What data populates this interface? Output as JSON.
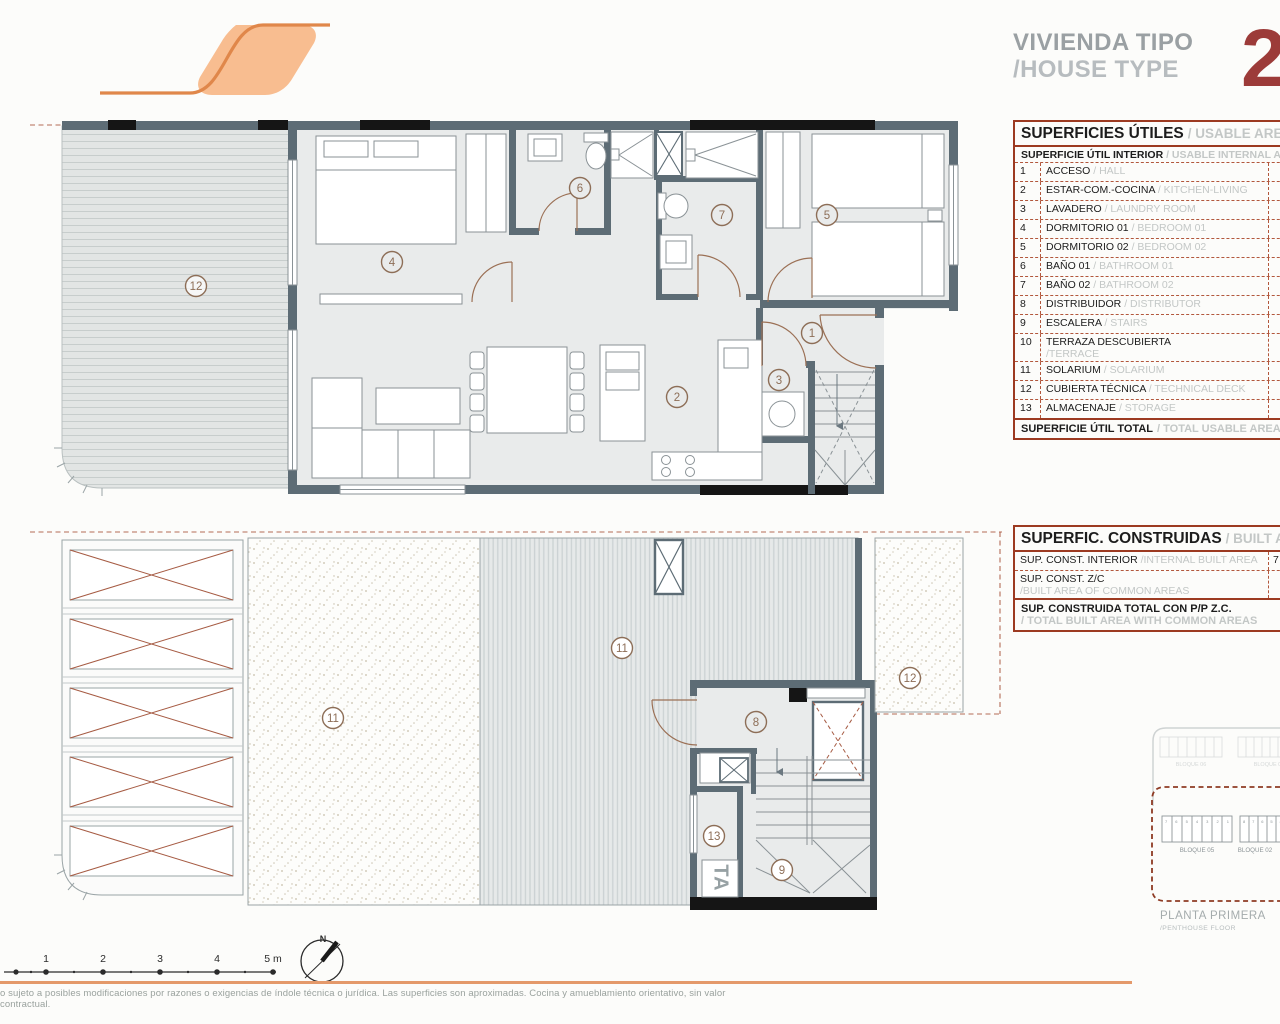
{
  "header": {
    "title_es": "VIVIENDA TIPO",
    "title_en": "/HOUSE TYPE",
    "type_number": "2"
  },
  "usable_table": {
    "title_es": "SUPERFICIES ÚTILES",
    "title_en": "/ USABLE AREA",
    "sub_es": "SUPERFICIE ÚTIL INTERIOR",
    "sub_en": "/ USABLE INTERNAL AREA",
    "rows": [
      {
        "n": "1",
        "es": "ACCESO",
        "en": "/ HALL"
      },
      {
        "n": "2",
        "es": "ESTAR-COM.-COCINA",
        "en": "/ KITCHEN-LIVING"
      },
      {
        "n": "3",
        "es": "LAVADERO",
        "en": "/ LAUNDRY ROOM"
      },
      {
        "n": "4",
        "es": "DORMITORIO 01",
        "en": "/ BEDROOM 01"
      },
      {
        "n": "5",
        "es": "DORMITORIO 02",
        "en": "/ BEDROOM 02"
      },
      {
        "n": "6",
        "es": "BAÑO 01",
        "en": "/ BATHROOM 01"
      },
      {
        "n": "7",
        "es": "BAÑO 02",
        "en": "/ BATHROOM 02"
      },
      {
        "n": "8",
        "es": "DISTRIBUIDOR",
        "en": "/ DISTRIBUTOR"
      },
      {
        "n": "9",
        "es": "ESCALERA",
        "en": "/ STAIRS"
      },
      {
        "n": "10",
        "es": "TERRAZA DESCUBIERTA",
        "en": "/TERRACE"
      },
      {
        "n": "11",
        "es": "SOLARIUM",
        "en": "/ SOLARIUM"
      },
      {
        "n": "12",
        "es": "CUBIERTA TÉCNICA",
        "en": "/ TECHNICAL DECK"
      },
      {
        "n": "13",
        "es": "ALMACENAJE",
        "en": "/ STORAGE"
      }
    ],
    "total_es": "SUPERFICIE ÚTIL TOTAL",
    "total_en": "/ TOTAL USABLE AREA",
    "total_value_partial": "14"
  },
  "built_table": {
    "title_es": "SUPERFIC. CONSTRUIDAS",
    "title_en": "/ BUILT AREA",
    "row1_es": "SUP. CONST. INTERIOR",
    "row1_en": "/INTERNAL BUILT AREA",
    "row1_value_partial": "7",
    "row2_es": "SUP. CONST. Z/C",
    "row2_en": "/BUILT AREA OF COMMON AREAS",
    "total_es": "SUP. CONSTRUIDA TOTAL CON P/P Z.C.",
    "total_en": "/ TOTAL BUILT AREA WITH COMMON AREAS",
    "total_value_partial": "8"
  },
  "plan_upper": {
    "labels": {
      "tech_deck": "12",
      "bedroom01": "4",
      "bath01": "6",
      "bath02": "7",
      "bedroom02": "5",
      "hall": "1",
      "laundry": "3",
      "living": "2"
    }
  },
  "plan_lower": {
    "labels": {
      "solarium_a": "11",
      "solarium_b": "11",
      "distributor": "8",
      "stairs": "9",
      "storage": "13",
      "tech_deck": "12"
    },
    "ta_label": "TA"
  },
  "site_plan": {
    "back_blocks": [
      "BLOQUE 06",
      "BLOQUE 03"
    ],
    "front_blocks": [
      "BLOQUE 05",
      "BLOQUE 02"
    ],
    "front_units": [
      "7 6 5 4 3 2 1",
      "8 7 6 5 4 3 2 1"
    ],
    "caption_es": "PLANTA PRIMERA",
    "caption_en": "/PENTHOUSE FLOOR"
  },
  "scale_bar": {
    "ticks": [
      "1",
      "2",
      "3",
      "4",
      "5 m"
    ]
  },
  "compass": {
    "label": "N"
  },
  "footer": {
    "disclaimer": "o sujeto a posibles modificaciones por razones o exigencias de índole técnica o jurídica. Las superficies son aproximadas. Cocina y amueblamiento orientativo, sin valor contractual."
  },
  "colors": {
    "accent_orange": "#e4996a",
    "logo_fill": "#f8bd90",
    "logo_line": "#e0874a",
    "wall": "#5d6c75",
    "table_border": "#9c3a21",
    "dashed_red": "#b2573c",
    "type_number_red": "#9c3b39",
    "title_gray": "#9aa0a3",
    "muted_en": "#c3c7c6",
    "room_circle": "#8d6e57"
  }
}
